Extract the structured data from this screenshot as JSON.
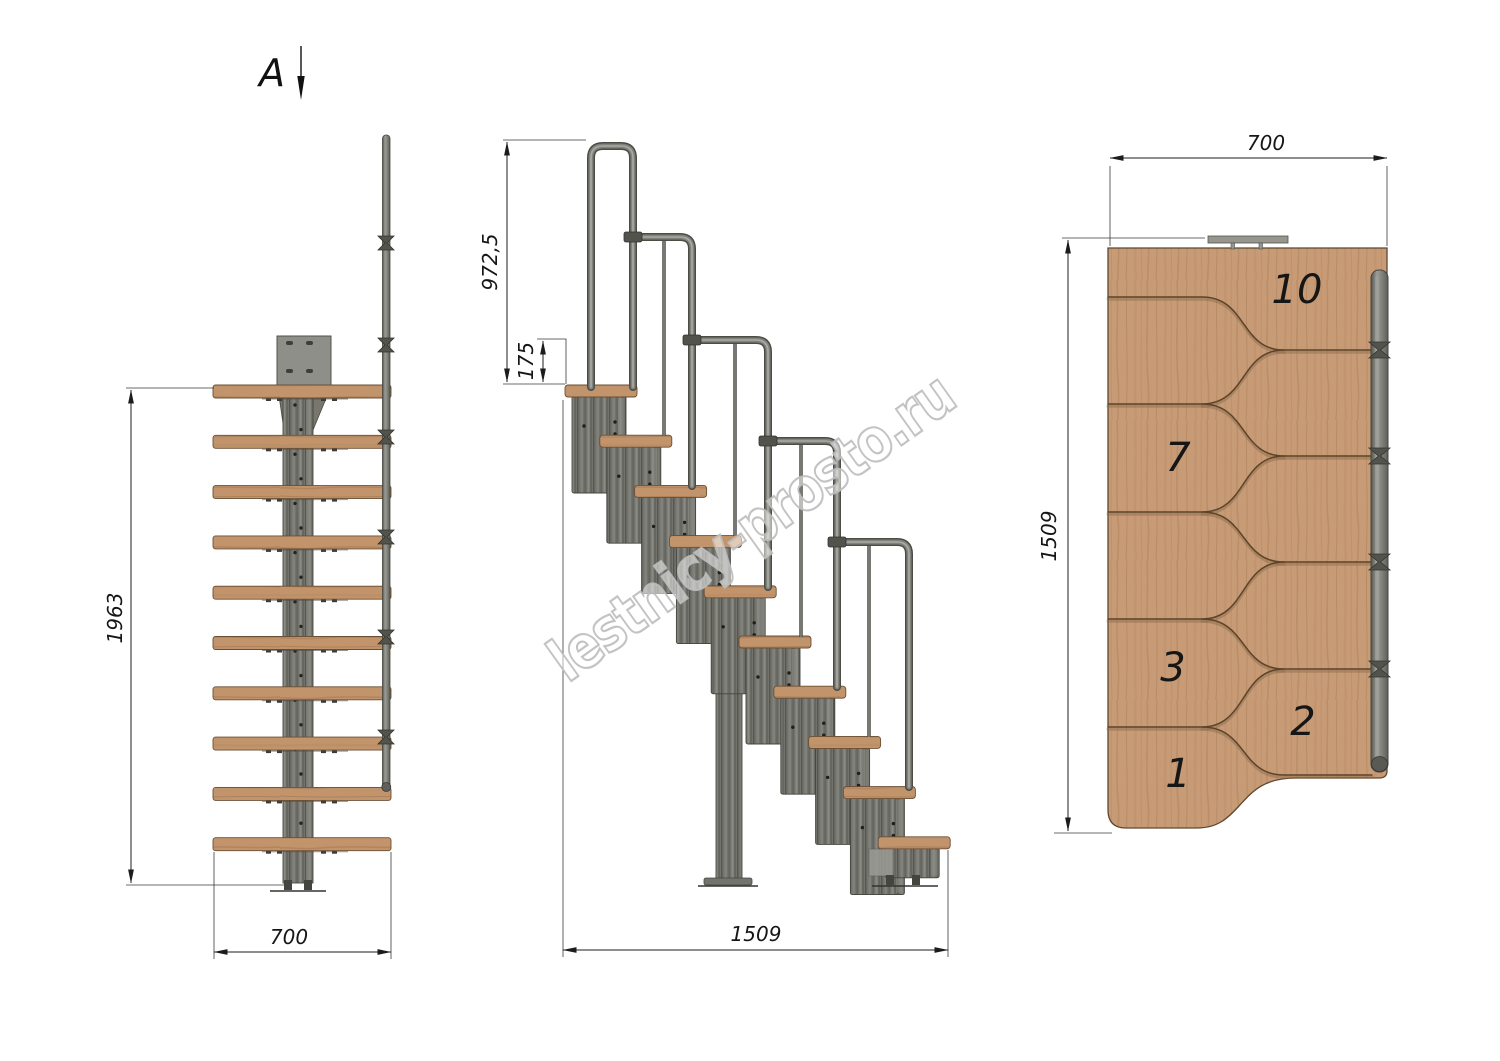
{
  "section_marker": {
    "label": "A"
  },
  "watermark": {
    "text": "lestnicy-prosto.ru"
  },
  "front_view": {
    "steps_count": 10,
    "dims": {
      "height": "1963",
      "width": "700"
    }
  },
  "side_view": {
    "steps_count": 10,
    "dims": {
      "handrail_height": "972,5",
      "top_rise": "175",
      "length": "1509"
    }
  },
  "top_view": {
    "dims": {
      "width": "700",
      "depth": "1509"
    },
    "step_numbers": [
      "10",
      "7",
      "3",
      "2",
      "1"
    ]
  },
  "colors": {
    "wood": "#c79b76",
    "metal": "#73736d",
    "line": "#1c1c1c",
    "watermark_stroke": "#bcbcbc"
  }
}
